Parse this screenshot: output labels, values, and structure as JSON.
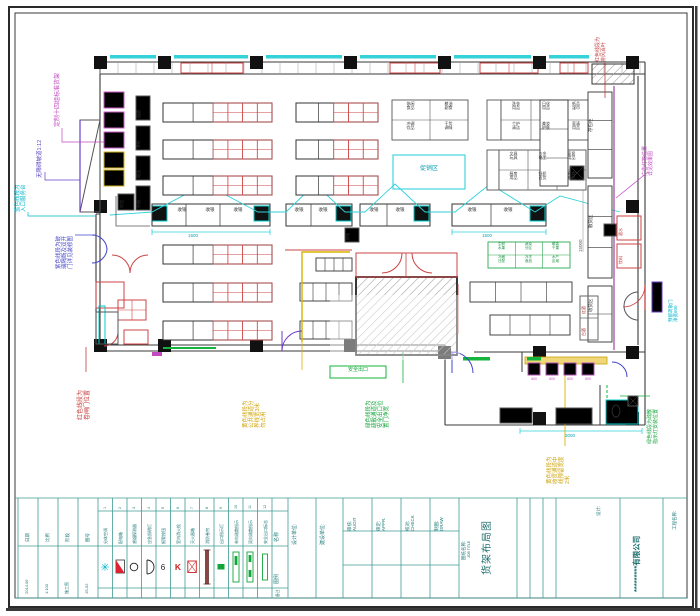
{
  "sheet": {
    "company": "*********有限公司",
    "project_label": "工程名称:",
    "design_label": "设计:",
    "job_title_label": "图纸名称:",
    "job_title_en": "JOB TITLE",
    "job_title": "货架布局图",
    "unit_labels": [
      "设计单位:",
      "建设单位:"
    ],
    "sign_fields": [
      {
        "label": "审核:",
        "en": "AUDIT"
      },
      {
        "label": "审定:",
        "en": "APPR."
      },
      {
        "label": "校对:",
        "en": "CHECK"
      },
      {
        "label": "制图:",
        "en": "DRAW"
      }
    ],
    "info_fields": [
      {
        "label": "日期",
        "value": "2014.06"
      },
      {
        "label": "比例",
        "value": "1:100"
      },
      {
        "label": "阶段",
        "value": "施工图"
      },
      {
        "label": "图号",
        "value": "JS-02"
      }
    ]
  },
  "legend": {
    "row_labels": {
      "name": "名称",
      "symbol": "图例",
      "note": "备注"
    },
    "items": [
      {
        "no": "1",
        "name": "分体空调",
        "symbol": "ac"
      },
      {
        "no": "2",
        "name": "配电箱",
        "symbol": "panel"
      },
      {
        "no": "3",
        "name": "感烟探测器",
        "symbol": "circle"
      },
      {
        "no": "4",
        "name": "应急照明灯",
        "symbol": "dlamp"
      },
      {
        "no": "5",
        "name": "报警按钮",
        "symbol": "button"
      },
      {
        "no": "6",
        "name": "室内消火栓",
        "symbol": "hydrant"
      },
      {
        "no": "7",
        "name": "灭火器箱",
        "symbol": "extbox"
      },
      {
        "no": "8",
        "name": "消防卷帘",
        "symbol": "shutter"
      },
      {
        "no": "9",
        "name": "出口指示灯",
        "symbol": "exitsmall"
      },
      {
        "no": "10",
        "name": "单向疏散指示",
        "symbol": "exit1"
      },
      {
        "no": "11",
        "name": "双向疏散指示",
        "symbol": "exit2"
      },
      {
        "no": "12",
        "name": "安全出口标志",
        "symbol": "exit3"
      }
    ]
  },
  "annotations": {
    "tl_magenta": "定制十四组标准货架",
    "left_purple": "无障碍坡道1:12",
    "left_cyan": "蓝色线段为\n入口服务台",
    "left_blue": "紫色线段为玻\n璃隔断及双开\n门详见装修图",
    "bl_red": "红色线段为\n卷闸门位置",
    "bottom_yellow": "黄色线段为\n公共通道分\n界线宽3米\n勿占用",
    "center_green": "绿色线段为\n疏散通道及\n安全出口位\n置门净宽",
    "right_yellow": "黄色线段为\n收货通道中\n线预留宽度\n2米",
    "right_green": "绿色线段为疏散\n指示灯安装位置",
    "right_cyan": "预留疏散门\n净宽600",
    "tr_red": "红色线段为\n排风百叶",
    "right_magenta": "广告灯箱位置\n详见效果图"
  },
  "plan": {
    "checkout": "收银",
    "promo": "促销区",
    "exit_box": "安全出口",
    "locker": "存包",
    "small_sq": "配电",
    "fixture_dim": "600",
    "grid1": [
      "休闲\n食品",
      "粮油\n副食",
      "冲调\n饮品",
      "干货\n调味"
    ],
    "grid2": [
      "洗衣\n用品",
      "日化\n用品",
      "纸品\n湿巾",
      "个护\n清洁",
      "美妆\n护肤",
      "家清\n用品"
    ],
    "grid3": [
      "文具\n玩具",
      "五金\n电工",
      "家居\n用品",
      "厨房\n用品",
      "针织\n百货",
      "鞋帽\n箱包"
    ],
    "green_grid": [
      "生鲜\n水果",
      "蔬菜\n分区",
      "散装\n干果",
      "冷藏\n日配",
      "冷冻\n食品",
      "水产\n区域"
    ],
    "side_counters": [
      "存包柜",
      "散货区",
      "收货区"
    ],
    "side_boxes": [
      "酒水",
      "饮料"
    ],
    "small_boxes": [
      "烟酒",
      "茶叶",
      "粮油",
      "杂粮"
    ],
    "wine_boxes": [
      "红酒",
      "白酒"
    ],
    "dims": {
      "d1": "1500",
      "d2": "1500",
      "d3": "3000",
      "d4": "15000"
    }
  }
}
